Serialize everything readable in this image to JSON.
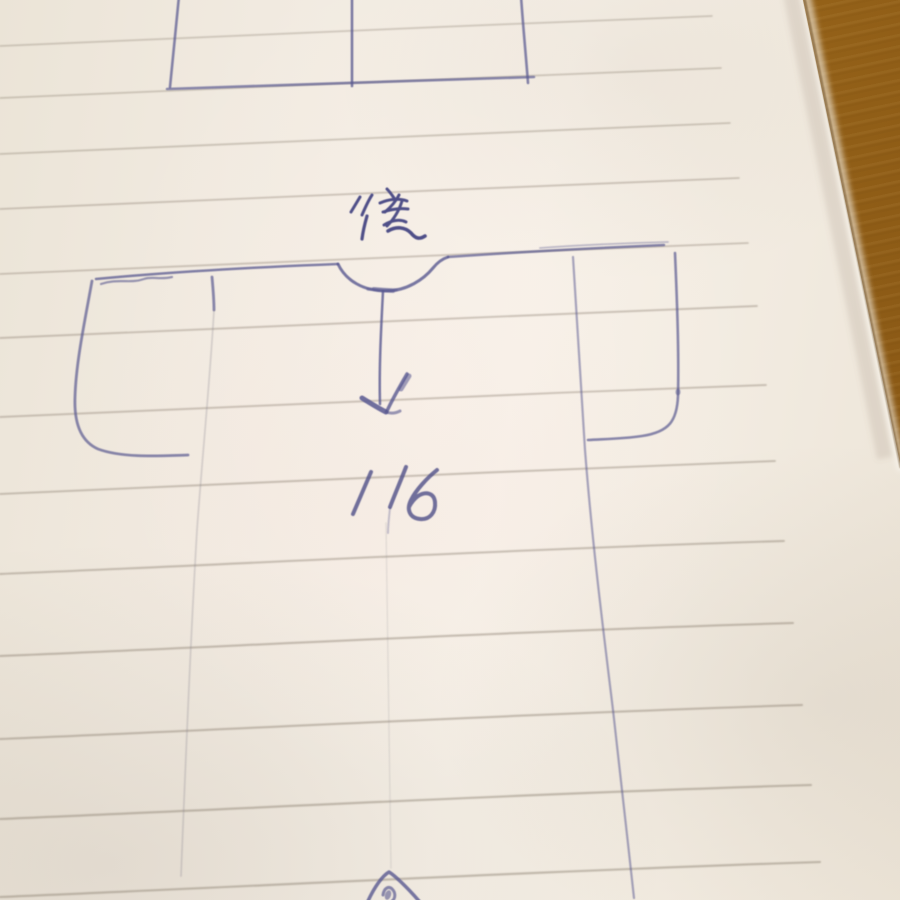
{
  "annotations": {
    "back_label": "後",
    "measurement": "116"
  },
  "colors": {
    "ink": "#585890",
    "ink-dark": "#4f4f88",
    "rule": "#93887a",
    "paper": "#f2ebe1",
    "wood": "#9c671e"
  }
}
